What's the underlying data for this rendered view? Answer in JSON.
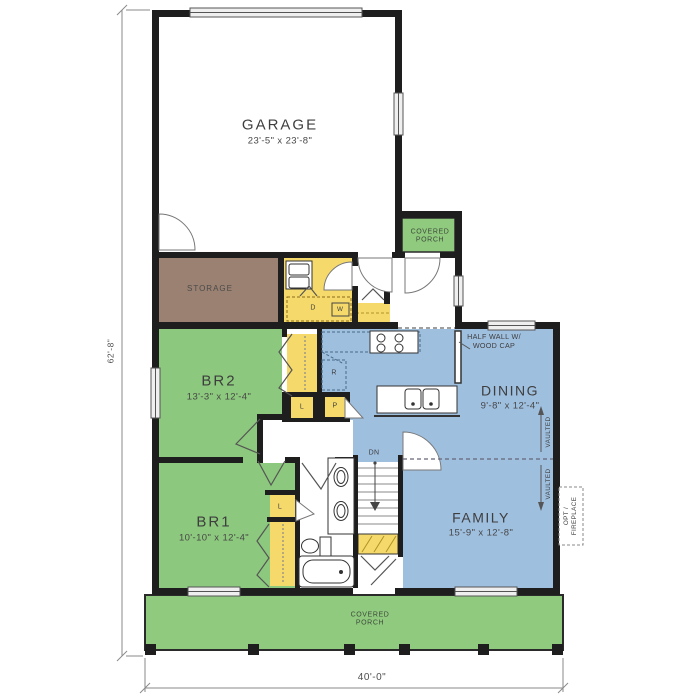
{
  "rooms": {
    "garage": {
      "name": "GARAGE",
      "dims": "23'-5\" x 23'-8\""
    },
    "storage": {
      "name": "STORAGE"
    },
    "porch_upper": {
      "line1": "COVERED",
      "line2": "PORCH"
    },
    "br2": {
      "name": "BR2",
      "dims": "13'-3\" x 12'-4\""
    },
    "dining": {
      "name": "DINING",
      "dims": "9'-8\" x 12'-4\""
    },
    "br1": {
      "name": "BR1",
      "dims": "10'-10\" x 12'-4\""
    },
    "family": {
      "name": "FAMILY",
      "dims": "15'-9\" x 12'-8\""
    },
    "porch_lower": {
      "line1": "COVERED",
      "line2": "PORCH"
    }
  },
  "labels": {
    "half_wall_line1": "HALF WALL W/",
    "half_wall_line2": "WOOD CAP",
    "vaulted": "VAULTED",
    "dn": "DN",
    "opt_line1": "OPT /",
    "opt_line2": "FIREPLACE",
    "dryer": "D",
    "washer": "W",
    "range": "R",
    "linen": "L",
    "pantry": "P"
  },
  "dimensions": {
    "width": "40'-0\"",
    "height": "62'-8\""
  },
  "colors": {
    "wall": "#1e1e1e",
    "bedroom_green": "#8cc87d",
    "porch_green": "#8fca7e",
    "living_blue": "#9fbfdf",
    "closet_yellow": "#f5da6b",
    "storage_brown": "#9b8172",
    "dimension_gray": "#8a8a8a"
  }
}
